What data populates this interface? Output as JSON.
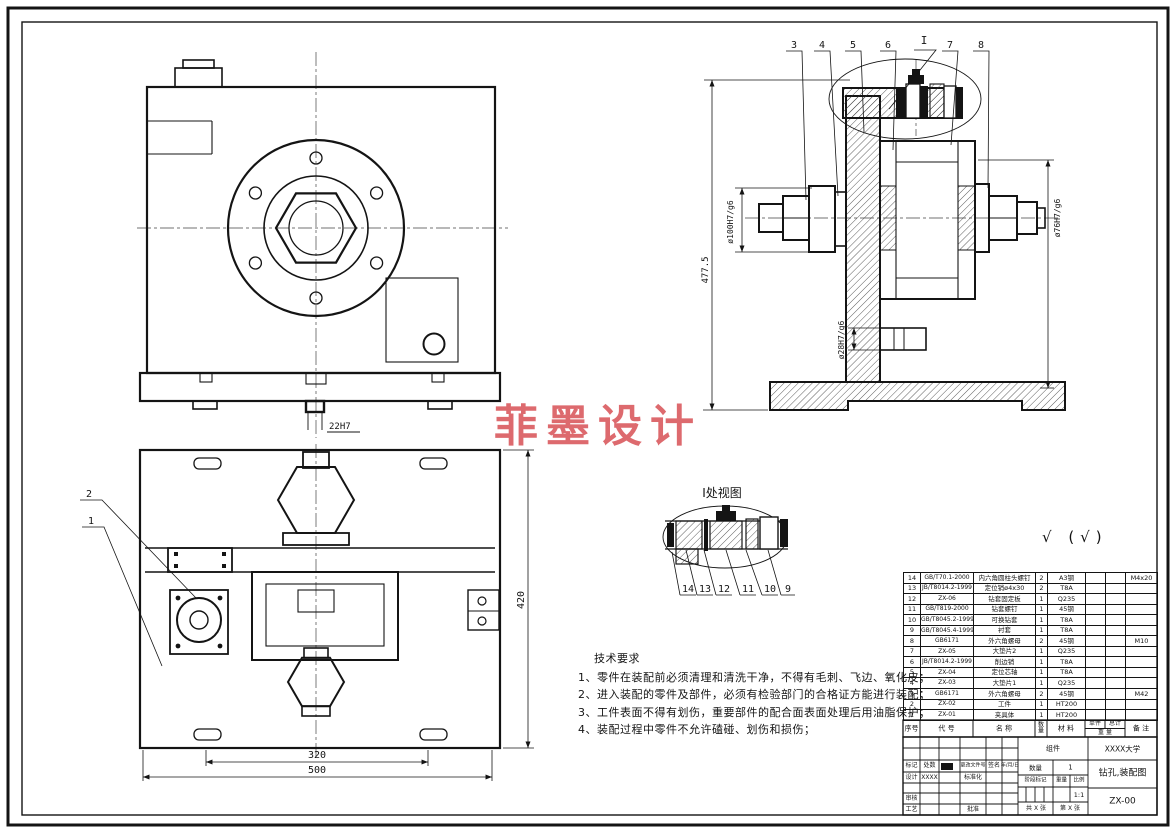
{
  "watermark": {
    "text": "菲墨设计",
    "color": "#d9565b"
  },
  "surface_note": "√ (√)",
  "views": {
    "front": {
      "tenon_dim": "22H7"
    },
    "section": {
      "callouts": [
        "3",
        "4",
        "5",
        "6",
        "I",
        "7",
        "8"
      ],
      "dim_height": "477.5",
      "dim_left": "ø100H7/g6",
      "dim_pin": "ø28H7/g6",
      "dim_right": "ø76H7/g6"
    },
    "detail": {
      "title": "I处视图",
      "callouts": [
        "14",
        "13",
        "12",
        "11",
        "10",
        "9"
      ]
    },
    "plan": {
      "callouts": [
        "2",
        "1"
      ],
      "dim_inner": "320",
      "dim_outer": "500",
      "dim_side": "420"
    }
  },
  "tech_req": {
    "title": "技术要求",
    "items": [
      "1、零件在装配前必须清理和清洗干净，不得有毛刺、飞边、氧化皮；",
      "2、进入装配的零件及部件，必须有检验部门的合格证方能进行装配；",
      "3、工件表面不得有划伤，重要部件的配合面表面处理后用油脂保护；",
      "4、装配过程中零件不允许磕碰、划伤和损伤；"
    ]
  },
  "bom": {
    "headers": {
      "no": "序号",
      "code": "代 号",
      "name": "名 称",
      "qty": "数量",
      "material": "材 料",
      "unit": "单件",
      "total": "总计",
      "weight": "重 量",
      "remark": "备 注"
    },
    "rows": [
      {
        "no": "14",
        "code": "GB/T70.1-2000",
        "name": "内六角圆柱头螺钉",
        "qty": "2",
        "material": "A3钢",
        "unit_weight": "",
        "total_weight": "",
        "remark": "M4x20"
      },
      {
        "no": "13",
        "code": "JB/T8014.2-1999",
        "name": "定位销ø4x30",
        "qty": "2",
        "material": "T8A",
        "unit_weight": "",
        "total_weight": "",
        "remark": ""
      },
      {
        "no": "12",
        "code": "ZX-06",
        "name": "钻套固定板",
        "qty": "1",
        "material": "Q235",
        "unit_weight": "",
        "total_weight": "",
        "remark": ""
      },
      {
        "no": "11",
        "code": "GB/T819-2000",
        "name": "钻套螺钉",
        "qty": "1",
        "material": "45钢",
        "unit_weight": "",
        "total_weight": "",
        "remark": ""
      },
      {
        "no": "10",
        "code": "GB/T8045.2-1999",
        "name": "可换钻套",
        "qty": "1",
        "material": "T8A",
        "unit_weight": "",
        "total_weight": "",
        "remark": ""
      },
      {
        "no": "9",
        "code": "GB/T8045.4-1999",
        "name": "衬套",
        "qty": "1",
        "material": "T8A",
        "unit_weight": "",
        "total_weight": "",
        "remark": ""
      },
      {
        "no": "8",
        "code": "GB6171",
        "name": "外六角螺母",
        "qty": "2",
        "material": "45钢",
        "unit_weight": "",
        "total_weight": "",
        "remark": "M10"
      },
      {
        "no": "7",
        "code": "ZX-05",
        "name": "大垫片2",
        "qty": "1",
        "material": "Q235",
        "unit_weight": "",
        "total_weight": "",
        "remark": ""
      },
      {
        "no": "6",
        "code": "JB/T8014.2-1999",
        "name": "削边销",
        "qty": "1",
        "material": "T8A",
        "unit_weight": "",
        "total_weight": "",
        "remark": ""
      },
      {
        "no": "5",
        "code": "ZX-04",
        "name": "定位芯轴",
        "qty": "1",
        "material": "T8A",
        "unit_weight": "",
        "total_weight": "",
        "remark": ""
      },
      {
        "no": "4",
        "code": "ZX-03",
        "name": "大垫片1",
        "qty": "1",
        "material": "Q235",
        "unit_weight": "",
        "total_weight": "",
        "remark": ""
      },
      {
        "no": "3",
        "code": "GB6171",
        "name": "外六角螺母",
        "qty": "2",
        "material": "45钢",
        "unit_weight": "",
        "total_weight": "",
        "remark": "M42"
      },
      {
        "no": "2",
        "code": "ZX-02",
        "name": "工件",
        "qty": "1",
        "material": "HT200",
        "unit_weight": "",
        "total_weight": "",
        "remark": ""
      },
      {
        "no": "1",
        "code": "ZX-01",
        "name": "夹具体",
        "qty": "1",
        "material": "HT200",
        "unit_weight": "",
        "total_weight": "",
        "remark": ""
      }
    ]
  },
  "title_block": {
    "mark": "标记",
    "count": "处数",
    "change_file": "更改文件号",
    "sign": "签名",
    "date": "年/月/日",
    "design": "设计",
    "design_name": "XXXX",
    "standardize": "标准化",
    "review": "审核",
    "process": "工艺",
    "approve": "批准",
    "assembly": "组件",
    "school": "XXXX大学",
    "qty_label": "数量",
    "qty_value": "1",
    "stage_label": "阶段标记",
    "weight_label": "重量",
    "scale_label": "比例",
    "scale_value": "1:1",
    "drawing_title": "钻孔,装配图",
    "drawing_no": "ZX-00",
    "sheet_total": "共 X 张",
    "sheet_no": "第 X 张"
  }
}
